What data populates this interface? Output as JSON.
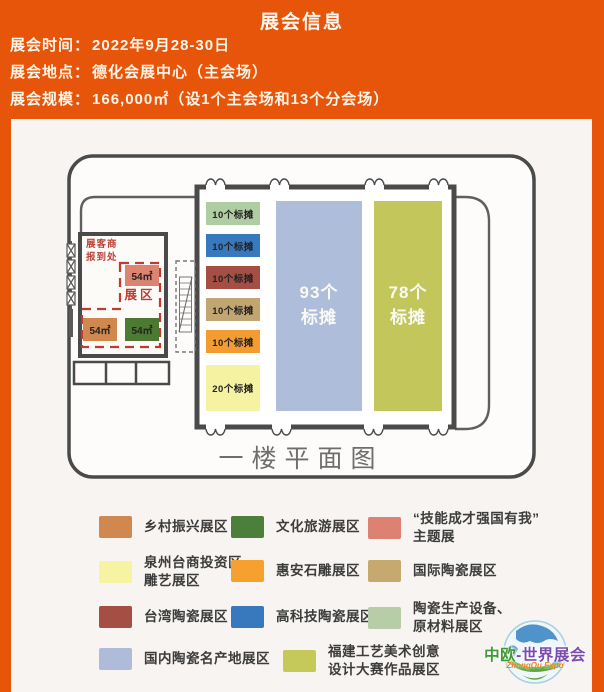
{
  "header": {
    "title": "展会信息",
    "info": [
      {
        "label": "展会时间：",
        "value": "2022年9月28-30日"
      },
      {
        "label": "展会地点：",
        "value": "德化会展中心（主会场）"
      },
      {
        "label": "展会规模：",
        "value": "166,000㎡（设1个主会场和13个分会场）"
      }
    ]
  },
  "floorplan": {
    "caption": "一楼平面图",
    "registration_label": "展客商\n报到处",
    "zone_label": "展区",
    "zone_blocks": [
      {
        "label": "54㎡",
        "color": "#DC8372"
      },
      {
        "label": "54㎡",
        "color": "#D0884E"
      },
      {
        "label": "54㎡",
        "color": "#4C7A33"
      }
    ],
    "booths": [
      {
        "label": "10个标摊",
        "color": "#AFCDA3"
      },
      {
        "label": "10个标摊",
        "color": "#3879BD"
      },
      {
        "label": "10个标摊",
        "color": "#A44E44"
      },
      {
        "label": "10个标摊",
        "color": "#C2A671"
      },
      {
        "label": "10个标摊",
        "color": "#F49C32"
      },
      {
        "label": "20个标摊",
        "color": "#F5F2A1"
      }
    ],
    "halls": [
      {
        "label": "93个\n标摊",
        "color": "#AEBDD9"
      },
      {
        "label": "78个\n标摊",
        "color": "#C3C75B"
      }
    ]
  },
  "legend": {
    "items": [
      {
        "label": "乡村振兴展区",
        "color": "#D0884E"
      },
      {
        "label": "文化旅游展区",
        "color": "#4C7E3C"
      },
      {
        "label": "“技能成才强国有我”\n主题展",
        "color": "#DD8173"
      },
      {
        "label": "泉州台商投资区\n雕艺展区",
        "color": "#F6F3A2"
      },
      {
        "label": "惠安石雕展区",
        "color": "#F6A02F"
      },
      {
        "label": "国际陶瓷展区",
        "color": "#C6A96E"
      },
      {
        "label": "台湾陶瓷展区",
        "color": "#A44E44"
      },
      {
        "label": "高科技陶瓷展区",
        "color": "#3879BD"
      },
      {
        "label": "陶瓷生产设备、\n原材料展区",
        "color": "#B7CDA8"
      },
      {
        "label": "国内陶瓷名产地展区",
        "color": "#AEBBD9"
      },
      {
        "label": "福建工艺美术创意\n设计大赛作品展区",
        "color": "#C5C95A"
      }
    ]
  },
  "logo": {
    "part1": "中欧",
    "part2": "-世界展会",
    "subtitle": "ZhongOu Expo"
  }
}
